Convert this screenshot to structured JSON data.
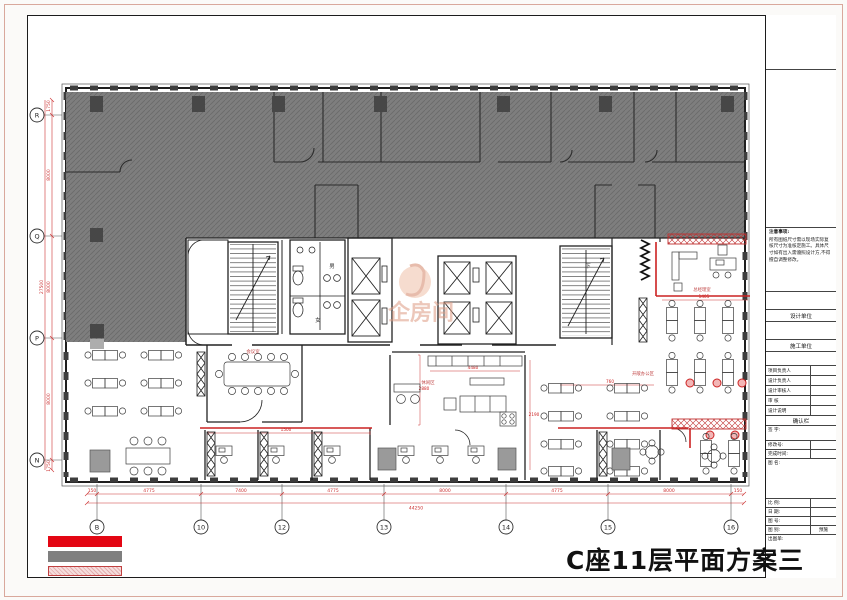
{
  "title": "C座11层平面方案三",
  "watermark": {
    "text": "企房间",
    "color": "#dd9b82"
  },
  "grid": {
    "bottom": [
      "B",
      "10",
      "12",
      "13",
      "14",
      "15",
      "16"
    ],
    "left": [
      "R",
      "Q",
      "P",
      "N"
    ]
  },
  "dimensions": {
    "bottom_segments": [
      "4775",
      "7400",
      "4775",
      "8000",
      "4775",
      "8000"
    ],
    "bottom_ends": [
      "150",
      "150"
    ],
    "bottom_total": "44250",
    "left_segments": [
      "8000",
      "8000",
      "8000"
    ],
    "left_ends": [
      "1750",
      "1750"
    ],
    "left_total": "27500",
    "inner_samples": [
      "1500",
      "2880",
      "4480",
      "1405",
      "760",
      "2190"
    ]
  },
  "core_labels": {
    "male": "男",
    "female": "女",
    "down": "下"
  },
  "room_labels": [
    "会议室",
    "休闲区",
    "总经理室",
    "开敞办公区",
    "洽谈室"
  ],
  "legend": {
    "swatches": [
      {
        "name": "red-solid",
        "color": "#e30613"
      },
      {
        "name": "gray-solid",
        "color": "#7f7f7f"
      },
      {
        "name": "red-hatch",
        "color": "#f6dddd",
        "border": "#c04040"
      }
    ]
  },
  "colors": {
    "annotation_red": "#cc2222",
    "wall_black": "#1c1c1c",
    "demolition_gray": "#7e7e7e"
  },
  "title_block": {
    "notes_title": "注意事项:",
    "notes_body": "所有图纸尺寸需以现场实际复核尺寸为准核定施工。具体尺寸如有出入需遵照设计方,不得擅自调整修改。",
    "design_unit_label": "设计单位",
    "construction_unit_label": "施工单位",
    "person_rows": [
      "项目负责人",
      "设计负责人",
      "设计审核人",
      "审    核",
      "设计说明"
    ],
    "confirm_label": "确认栏",
    "sign_label": "签  字:",
    "rev_label": "修改号:",
    "time_label": "完成时间:",
    "name_label": "图  名:",
    "scale_label": "比  例:",
    "date_label": "日  期:",
    "no_label": "图  号:",
    "type_label": "图  别:",
    "type_value": "预施",
    "plot_label": "出图单:"
  }
}
